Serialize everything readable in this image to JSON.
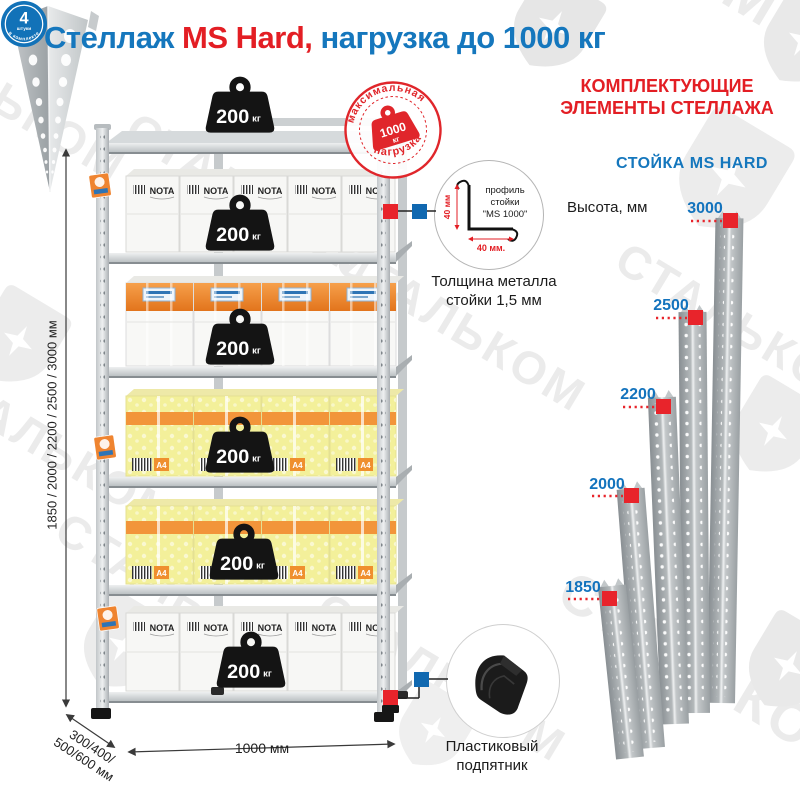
{
  "title": {
    "part1": "Стеллаж",
    "part2": " MS Hard,",
    "part3": " нагрузка до 1000 кг"
  },
  "watermark": {
    "text": "СТАЛЬКОМ"
  },
  "stamp": {
    "arc_top": "максимальная",
    "arc_bottom": "нагрузка",
    "value": "1000",
    "unit": "кг"
  },
  "rack": {
    "load_value": "200",
    "load_unit": "кг",
    "box_brand": "NOTA",
    "paper_label": "A4",
    "height_options": "1850 / 2000 / 2200 / 2500 / 3000 мм",
    "depth_options_line1": "300/400/",
    "depth_options_line2": "500/600 мм",
    "width_label": "1000 мм"
  },
  "profile": {
    "callout_line1": "профиль",
    "callout_line2": "стойки",
    "callout_line3": "\"MS 1000\"",
    "dim_vertical": "40 мм",
    "dim_horizontal": "40 мм.",
    "thickness_line1": "Толщина металла",
    "thickness_line2": "стойки 1,5 мм"
  },
  "foot": {
    "badge_value": "4",
    "badge_unit": "штуки",
    "badge_arc": "в комплекте",
    "caption_line1": "Пластиковый",
    "caption_line2": "подпятник"
  },
  "components": {
    "heading_line1": "КОМПЛЕКТУЮЩИЕ",
    "heading_line2": "ЭЛЕМЕНТЫ СТЕЛЛАЖА",
    "subheading": "СТОЙКА MS HARD",
    "height_label": "Высота, мм",
    "posts": [
      {
        "height": "1850"
      },
      {
        "height": "2000"
      },
      {
        "height": "2200"
      },
      {
        "height": "2500"
      },
      {
        "height": "3000"
      }
    ]
  },
  "colors": {
    "blue": "#1577bd",
    "red": "#e31e24"
  }
}
